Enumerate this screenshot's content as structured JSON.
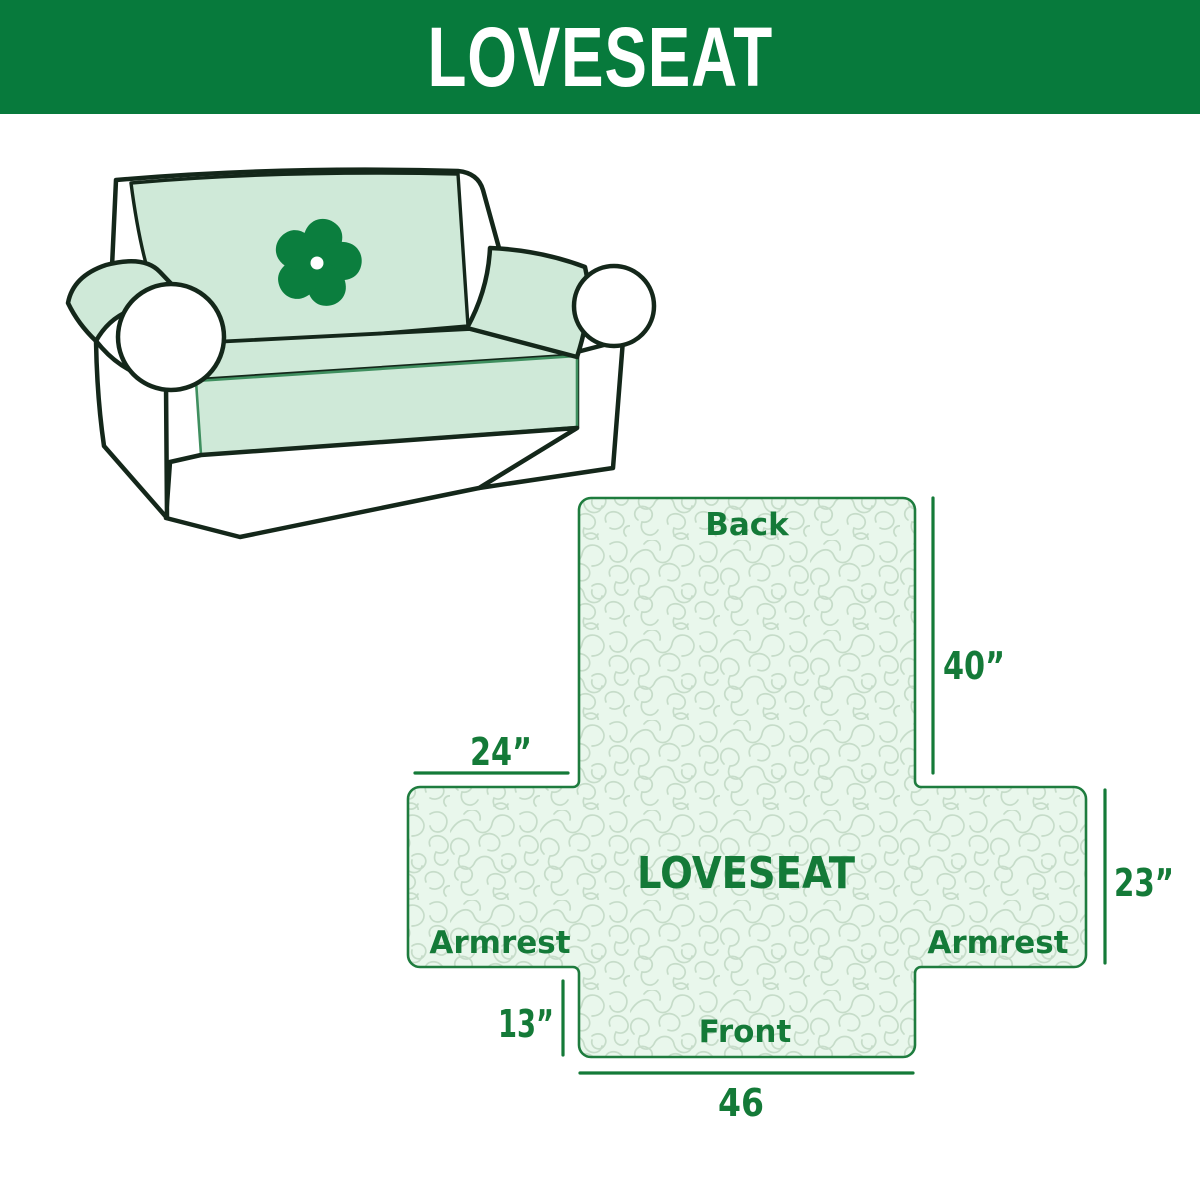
{
  "header": {
    "title": "LOVESEAT",
    "bg_color": "#077a3c",
    "text_color": "#ffffff"
  },
  "illustration": {
    "description": "Loveseat sofa with mint quilted slipcover on back, seat and armrests",
    "logo_icon": "pinwheel-icon",
    "cover_color": "#cfe9d8",
    "outline_color": "#14271a",
    "logo_color": "#0b7e3e"
  },
  "diagram": {
    "product_label": "LOVESEAT",
    "areas": {
      "back": "Back",
      "front": "Front",
      "armrest_left": "Armrest",
      "armrest_right": "Armrest"
    },
    "dimensions": {
      "back_height": "40”",
      "armrest_top_width": "24”",
      "armrest_side_height": "23”",
      "front_drop_height": "13”",
      "front_width": "46"
    },
    "accent_color": "#147a38",
    "border_color": "#1e7c3e",
    "fill_color": "#e9f7ec",
    "pattern_line_color": "#c6dcc9"
  }
}
